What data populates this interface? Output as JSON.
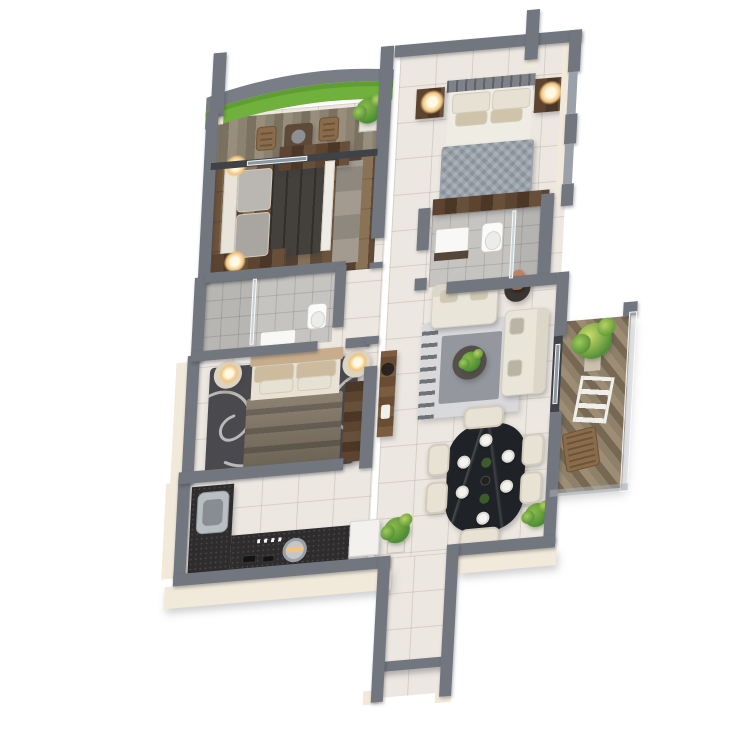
{
  "scene": {
    "type": "3d-floor-plan-render",
    "description": "Isometric 3D rendering of a two-bedroom apartment floor plan on a white background, viewed from above with slight perspective. No text labels are visible.",
    "background": "#ffffff"
  },
  "palette": {
    "wall": "#72767f",
    "wallDark": "#5d6169",
    "cream": "#f1e9d9",
    "tile": "#ece7e0",
    "bathtile": "#c6c4c1",
    "glass": "rgba(203,224,231,0.55)",
    "grass": "#6fb13c",
    "grassLight": "#86c44f",
    "rugDark": "#4a4a4e",
    "rugLivingOuter": "#d9d9db",
    "rugLivingMid": "#94989e",
    "sofa": "#eae5d9",
    "counter": "#2e2c2d",
    "tableBlack": "#1f2226",
    "chair": "#e8e2d5",
    "plant": "#4d8c35",
    "plantLight": "#8abb4a",
    "lamp": "#f3c57c",
    "headboardTan": "#c7ad8b",
    "duvetMaster": "#99a1aa",
    "duvetBed1": "#44403b",
    "duvetBed2A": "#8d8173",
    "duvetBed2B": "#6a6254",
    "vase": "#c08163",
    "deckWood": "#8c8271",
    "floorWood": "#6b533c"
  },
  "rooms": [
    {
      "name": "top-balcony",
      "features": [
        "curved-parapet",
        "grass-lawn",
        "wood-deck",
        "two-bistro-chairs",
        "bistro-table",
        "potted-plant"
      ]
    },
    {
      "name": "bedroom-1",
      "features": [
        "double-bed",
        "grey-pillows",
        "dark-duvet",
        "patch-rug",
        "dresser",
        "table-lamps",
        "wood-plank-floor",
        "wall-cabinet"
      ]
    },
    {
      "name": "master-bedroom",
      "features": [
        "double-bed",
        "grey-check-duvet",
        "two-nightstands",
        "two-lit-lamps",
        "foot-dresser",
        "tile-floor",
        "windows"
      ]
    },
    {
      "name": "master-bathroom",
      "features": [
        "vanity-basin",
        "toilet",
        "glass-shower",
        "wood-accent-strip",
        "grey-tile-floor"
      ]
    },
    {
      "name": "bathroom-2",
      "features": [
        "glass-shower-partition",
        "washbasin",
        "toilet",
        "grey-tile-floor"
      ]
    },
    {
      "name": "bedroom-2",
      "features": [
        "double-bed",
        "tan-headboard",
        "striped-duvet",
        "dark-swirl-rug",
        "round-nightstands",
        "lit-lamps",
        "wardrobe"
      ]
    },
    {
      "name": "hallway",
      "features": [
        "tv-console",
        "speaker",
        "tile-floor"
      ]
    },
    {
      "name": "living-room",
      "features": [
        "loveseat",
        "three-seat-sofa",
        "tribal-rug",
        "coffee-table-with-plant",
        "side-table",
        "terracotta-vase",
        "window-slider"
      ]
    },
    {
      "name": "dining-area",
      "features": [
        "black-marble-table",
        "six-cream-chairs",
        "place-settings",
        "corner-plant"
      ]
    },
    {
      "name": "kitchen",
      "features": [
        "l-shaped-dark-counter",
        "steel-sink",
        "hob-with-hood",
        "white-appliance",
        "potted-plant"
      ]
    },
    {
      "name": "right-balcony",
      "features": [
        "diagonal-wood-deck",
        "potted-plant",
        "ladder-shelf",
        "wood-chair",
        "glass-railing"
      ]
    },
    {
      "name": "entry-corridor",
      "features": [
        "tile-floor",
        "door-lintel",
        "entry-opening"
      ]
    }
  ],
  "counts": {
    "bedrooms": 3,
    "bathrooms": 2,
    "balconies": 2,
    "dining_chairs": 6,
    "lit_lamps": 6,
    "potted_plants": 6
  }
}
